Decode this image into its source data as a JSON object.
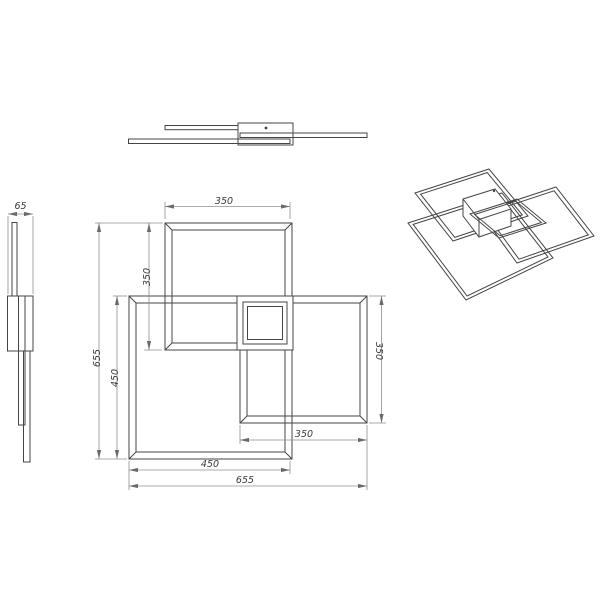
{
  "document": {
    "type": "technical-drawing",
    "subject": "ceiling-light-fixture-three-square-frames",
    "background_color": "#ffffff",
    "object_line_color": "#454545",
    "dimension_line_color": "#8f8f8f",
    "text_color": "#3a3a3a"
  },
  "views": {
    "front_view": {
      "name": "front elevation",
      "position": "top-center"
    },
    "side_view": {
      "name": "left side profile",
      "position": "left"
    },
    "plan_view": {
      "name": "plan view with dimensions",
      "position": "center"
    },
    "perspective_view": {
      "name": "3d perspective",
      "position": "top-right"
    }
  },
  "dims": {
    "height_side": "65",
    "top_width": "350",
    "left_inner": "350",
    "left_mid": "450",
    "left_outer": "655",
    "right_height": "350",
    "bottom_inner": "350",
    "bottom_mid": "450",
    "bottom_outer": "655"
  },
  "product_dimensions_mm": {
    "overall_width": 655,
    "overall_depth": 655,
    "overall_height": 65,
    "large_frame": 450,
    "small_frames": 350
  }
}
